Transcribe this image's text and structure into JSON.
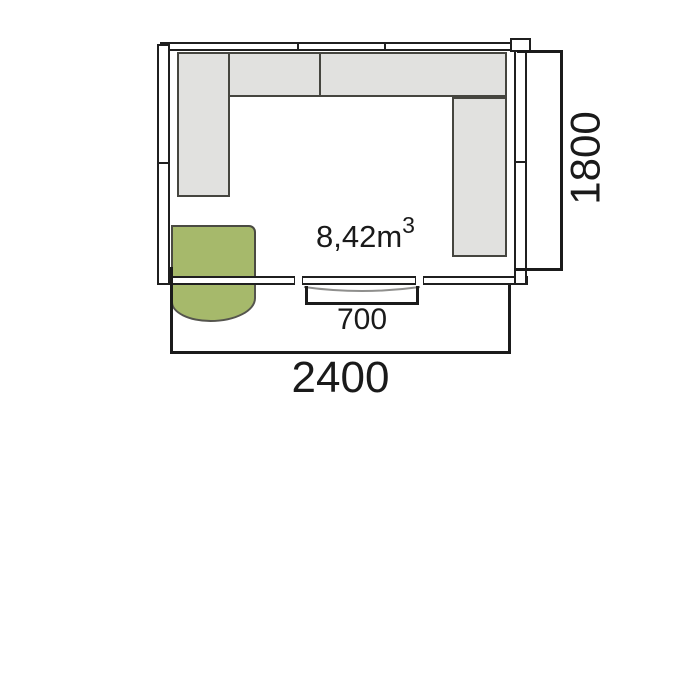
{
  "plan": {
    "volume_label": {
      "main": "8,42m",
      "superscript": "3"
    },
    "dimensions": {
      "door_width": "700",
      "overall_width": "2400",
      "overall_depth": "1800"
    },
    "colors": {
      "door_fill": "#a6b96b",
      "shelf_fill": "#e1e1df",
      "wall_line": "#1f1f1f",
      "dimension_line": "#1b1b1b",
      "threshold_arc": "#8f8f8d",
      "text": "#1a1a1a",
      "background": "#ffffff"
    }
  }
}
